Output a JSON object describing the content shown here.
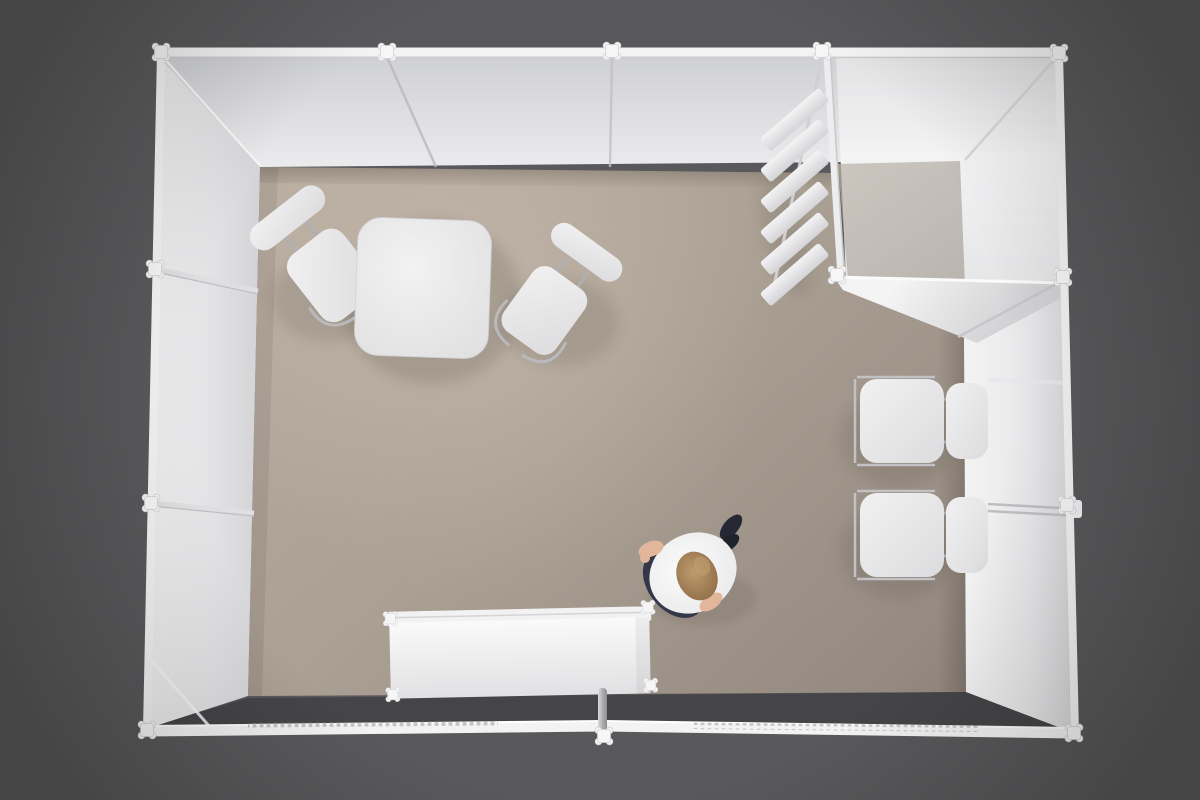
{
  "meta": {
    "title": "Exhibition booth — top-down 3D render",
    "canvas": {
      "width": 1200,
      "height": 800
    }
  },
  "colors": {
    "background": "#59595b",
    "ground_strip": "#454548",
    "frame": "#f3f3f4",
    "wall_bright": "#f1f1f3",
    "wall_mid": "#dddde0",
    "wall_dark": "#c9c9cc",
    "floor_light": "#b6aa9e",
    "floor_mid": "#aa9f93",
    "floor_dark": "#968b81",
    "closet_floor": "#8d8377",
    "furniture": "#ededef",
    "metal": "#b7b7ba",
    "smudge": "#9c9c9e",
    "person_top": "#f6f6f7",
    "person_skin": "#e2b69a",
    "person_hair": "#a8845b",
    "person_skirt": "#333747",
    "person_shoes": "#262836"
  },
  "scene": {
    "view": "top-down perspective render",
    "environment": "dark gray studio backdrop",
    "booth": {
      "walls_present": [
        "top",
        "left",
        "right"
      ],
      "front": "open entrance with low white fascia rail",
      "fascia_print": "faint illegible mirrored lettering on left and right fascia sections",
      "storage_room": "enclosed translucent cabin in the top-right corner with diagonal cross braces"
    },
    "objects": [
      {
        "name": "square-meeting-table",
        "location": "upper-left area of floor"
      },
      {
        "name": "side-chair",
        "location": "left of meeting table, angled"
      },
      {
        "name": "side-chair",
        "location": "right of meeting table, angled"
      },
      {
        "name": "zigzag-brochure-rack",
        "slats": 6,
        "location": "outside west wall of storage room"
      },
      {
        "name": "side-chair",
        "location": "against right wall, upper"
      },
      {
        "name": "side-chair",
        "location": "against right wall, lower"
      },
      {
        "name": "wall-mounted-rails",
        "location": "right wall beside chairs"
      },
      {
        "name": "reception-counter",
        "location": "bottom center at open front"
      },
      {
        "name": "entrance-post",
        "location": "front rail, center"
      },
      {
        "name": "person",
        "appearance": "woman, light hair, white top, dark skirt, dark shoes, walking toward upper right"
      }
    ]
  }
}
